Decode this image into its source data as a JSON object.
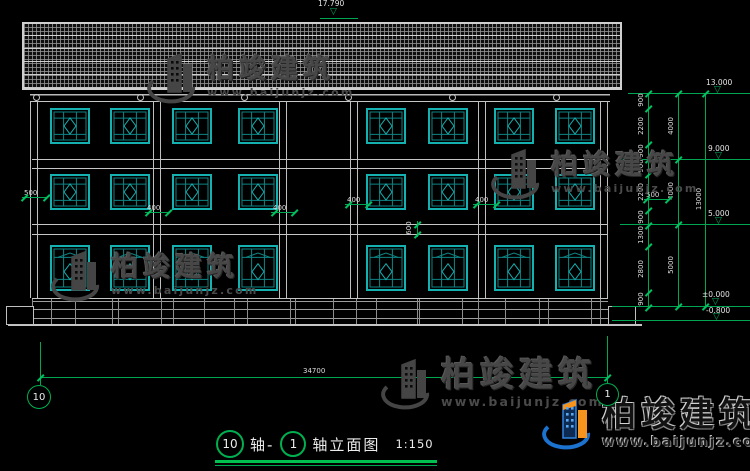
{
  "watermark": {
    "brand": "柏竣建筑",
    "url": "www.baijunjz.com"
  },
  "titlebar": {
    "bubble_left": "10",
    "joiner": "轴-",
    "bubble_right": "1",
    "title": "轴立面图",
    "scale": "1:150"
  },
  "axes": {
    "left_bubble": "10",
    "right_bubble": "1"
  },
  "elevations": {
    "ridge": "17.790",
    "eave": "13.000",
    "third": "9.000",
    "second": "5.000",
    "ground": "±0.000",
    "below": "-0.800"
  },
  "dimensions": {
    "overall_width": "34700",
    "overall_height": "13000",
    "floor_heights": [
      "4000",
      "4000",
      "5000"
    ],
    "right_inner_chain": [
      "900",
      "2200",
      "900",
      "900",
      "2200",
      "900",
      "1300",
      "2800",
      "900"
    ],
    "column_width_labels": [
      "400",
      "400",
      "400",
      "400"
    ],
    "floor_band_height": "600",
    "eave_overhang_left": "500",
    "eave_overhang_right": "500"
  },
  "facade": {
    "floors": 3,
    "bays": 5,
    "windows_per_full_bay": 2,
    "total_windows": 24,
    "roof_type": "tiled-hatch",
    "base": "stone-plinth"
  }
}
